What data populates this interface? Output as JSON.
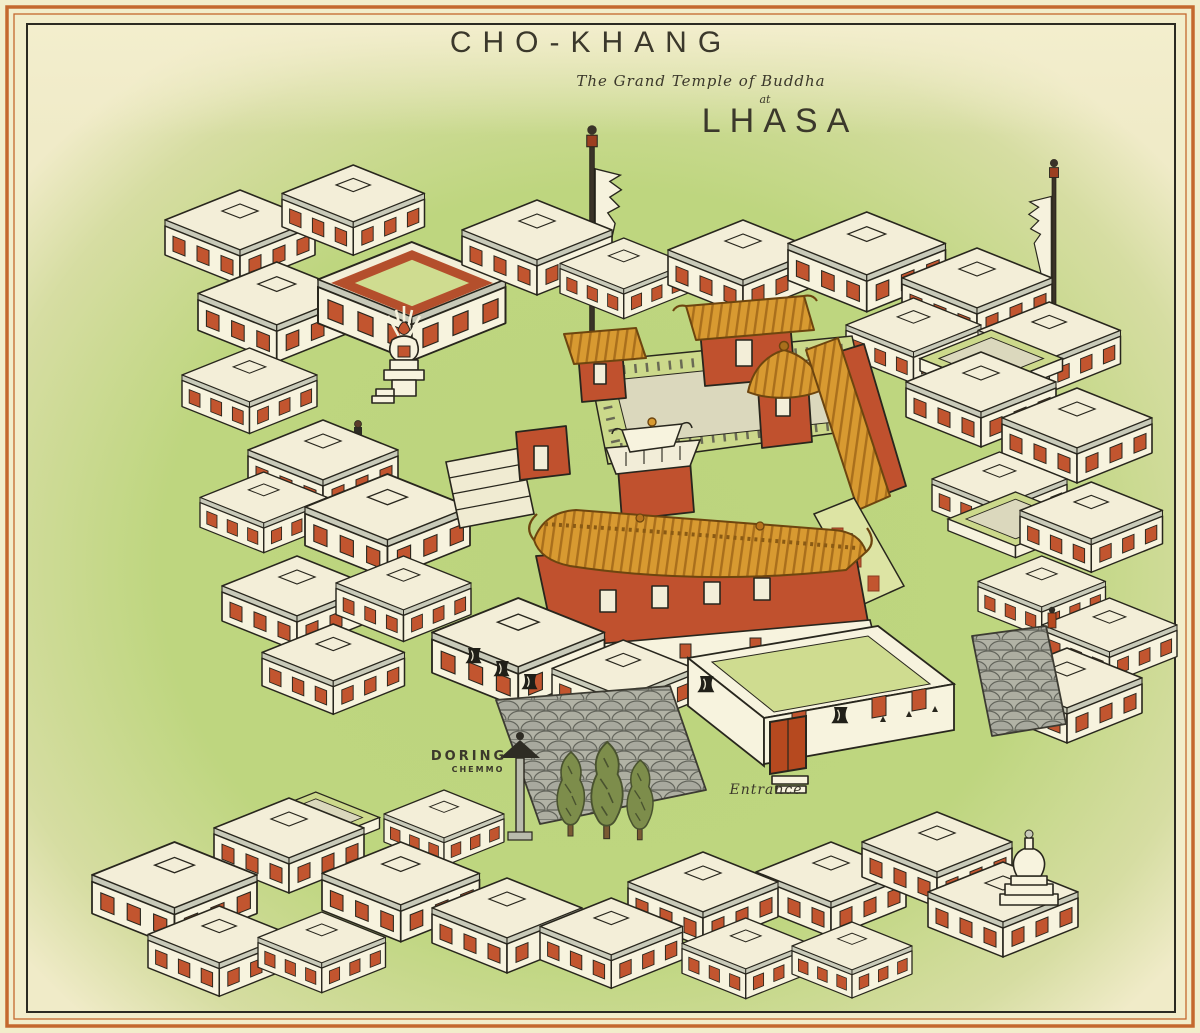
{
  "header": {
    "title": "CHO-KHANG",
    "subtitle": "The Grand Temple of Buddha",
    "connector": "at",
    "place": "LHASA"
  },
  "labels": {
    "doring": "DORING",
    "doring_sub": "CHEMMO",
    "entrance": "Entrance"
  },
  "features": [
    "grand-temple-with-golden-roofs",
    "inner-courtyard",
    "entrance-gate",
    "doring-chemmo-pillar",
    "incense-altar",
    "prayer-flag-poles",
    "cobblestone-courts",
    "cypress-trees",
    "chorten-stupa",
    "tibetan-houses-with-red-windows"
  ],
  "palette": {
    "paper": "#f2edcb",
    "ground_green": "#bcd47e",
    "building_cream": "#f7f3de",
    "window_red": "#c2552f",
    "temple_red": "#c0512e",
    "roof_gold": "#d89a31",
    "courtyard_green": "#ccd98b",
    "stone_grey": "#aaab9e",
    "tree_green": "#7d8d4b",
    "frame_orange": "#c4682e",
    "ink": "#28261d"
  }
}
